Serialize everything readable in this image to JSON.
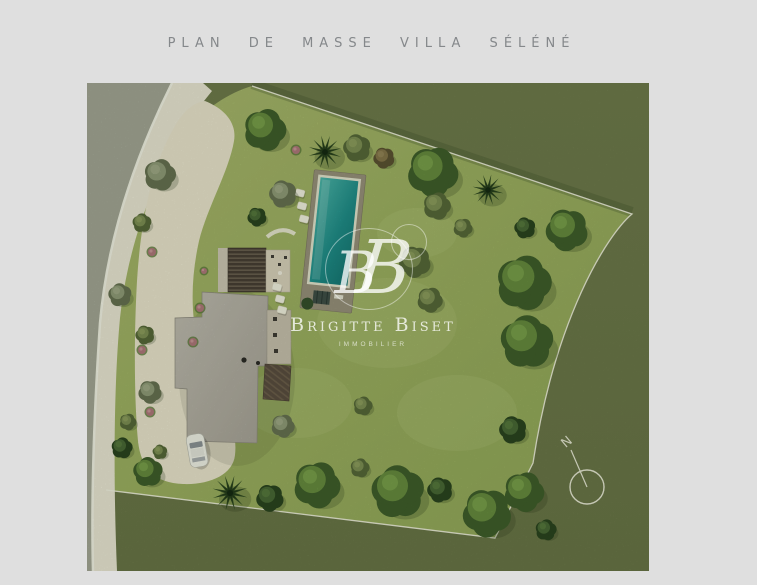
{
  "page": {
    "title": "PLAN DE MASSE VILLA SÉLÉNÉ",
    "title_color": "#85888b",
    "background_color": "#dfdfdf"
  },
  "watermark": {
    "monogram_left": "B",
    "monogram_right": "B",
    "name": "Brigitte Biset",
    "tagline": "IMMOBILIER",
    "color": "#ffffff"
  },
  "compass": {
    "label": "N"
  },
  "palette": {
    "pagebg": "#dfdfdf",
    "outside": "#6e7a4d",
    "lawn": "#9fb163",
    "verge": "#a4a79a",
    "road": "#ece8dc",
    "driveway": "#ece6d5",
    "roof": "#b5b1aa",
    "terrace": "#dbd3c3",
    "poolDeck": "#99927f",
    "boundary": "#f5f4ea"
  },
  "plan": {
    "trees": [
      {
        "x": 178,
        "y": 47,
        "r": 20,
        "tone": "green",
        "shape": "round"
      },
      {
        "x": 238,
        "y": 69,
        "r": 16,
        "tone": "dark",
        "shape": "palm"
      },
      {
        "x": 270,
        "y": 65,
        "r": 13,
        "tone": "olive",
        "shape": "round"
      },
      {
        "x": 297,
        "y": 75,
        "r": 10,
        "tone": "brown",
        "shape": "round"
      },
      {
        "x": 346,
        "y": 89,
        "r": 24,
        "tone": "green",
        "shape": "round"
      },
      {
        "x": 350,
        "y": 123,
        "r": 13,
        "tone": "olive",
        "shape": "round"
      },
      {
        "x": 401,
        "y": 107,
        "r": 15,
        "tone": "dark",
        "shape": "palm"
      },
      {
        "x": 438,
        "y": 145,
        "r": 10,
        "tone": "dark",
        "shape": "round"
      },
      {
        "x": 480,
        "y": 147,
        "r": 20,
        "tone": "green",
        "shape": "round"
      },
      {
        "x": 376,
        "y": 145,
        "r": 9,
        "tone": "olive",
        "shape": "round"
      },
      {
        "x": 437,
        "y": 200,
        "r": 26,
        "tone": "green",
        "shape": "round"
      },
      {
        "x": 440,
        "y": 259,
        "r": 25,
        "tone": "green",
        "shape": "round"
      },
      {
        "x": 426,
        "y": 347,
        "r": 13,
        "tone": "dark",
        "shape": "round"
      },
      {
        "x": 328,
        "y": 179,
        "r": 15,
        "tone": "olive",
        "shape": "round"
      },
      {
        "x": 343,
        "y": 217,
        "r": 12,
        "tone": "olive",
        "shape": "round"
      },
      {
        "x": 73,
        "y": 92,
        "r": 15,
        "tone": "gray",
        "shape": "round"
      },
      {
        "x": 55,
        "y": 140,
        "r": 9,
        "tone": "olive",
        "shape": "round"
      },
      {
        "x": 196,
        "y": 111,
        "r": 13,
        "tone": "gray",
        "shape": "round"
      },
      {
        "x": 170,
        "y": 134,
        "r": 9,
        "tone": "dark",
        "shape": "round"
      },
      {
        "x": 196,
        "y": 343,
        "r": 11,
        "tone": "gray",
        "shape": "round"
      },
      {
        "x": 276,
        "y": 323,
        "r": 9,
        "tone": "olive",
        "shape": "round"
      },
      {
        "x": 61,
        "y": 389,
        "r": 14,
        "tone": "green",
        "shape": "round"
      },
      {
        "x": 143,
        "y": 410,
        "r": 17,
        "tone": "dark",
        "shape": "palm"
      },
      {
        "x": 183,
        "y": 415,
        "r": 13,
        "tone": "dark",
        "shape": "round"
      },
      {
        "x": 230,
        "y": 402,
        "r": 22,
        "tone": "green",
        "shape": "round"
      },
      {
        "x": 273,
        "y": 385,
        "r": 9,
        "tone": "olive",
        "shape": "round"
      },
      {
        "x": 311,
        "y": 409,
        "r": 25,
        "tone": "green",
        "shape": "round"
      },
      {
        "x": 353,
        "y": 407,
        "r": 12,
        "tone": "dark",
        "shape": "round"
      },
      {
        "x": 400,
        "y": 430,
        "r": 23,
        "tone": "green",
        "shape": "round"
      },
      {
        "x": 437,
        "y": 409,
        "r": 19,
        "tone": "green",
        "shape": "round"
      },
      {
        "x": 459,
        "y": 447,
        "r": 10,
        "tone": "dark",
        "shape": "round"
      },
      {
        "x": 33,
        "y": 212,
        "r": 11,
        "tone": "gray",
        "shape": "round"
      },
      {
        "x": 58,
        "y": 252,
        "r": 9,
        "tone": "olive",
        "shape": "round"
      },
      {
        "x": 63,
        "y": 309,
        "r": 11,
        "tone": "gray",
        "shape": "round"
      },
      {
        "x": 41,
        "y": 339,
        "r": 8,
        "tone": "olive",
        "shape": "round"
      },
      {
        "x": 35,
        "y": 365,
        "r": 10,
        "tone": "dark",
        "shape": "round"
      },
      {
        "x": 73,
        "y": 369,
        "r": 7,
        "tone": "olive",
        "shape": "round"
      }
    ],
    "pink_bushes": [
      {
        "x": 65,
        "y": 169,
        "r": 4
      },
      {
        "x": 55,
        "y": 267,
        "r": 4
      },
      {
        "x": 63,
        "y": 329,
        "r": 4
      },
      {
        "x": 113,
        "y": 225,
        "r": 4
      },
      {
        "x": 106,
        "y": 259,
        "r": 4
      },
      {
        "x": 117,
        "y": 188,
        "r": 3
      },
      {
        "x": 209,
        "y": 67,
        "r": 4
      }
    ],
    "stepping_stones": [
      {
        "x": 213,
        "y": 110
      },
      {
        "x": 215,
        "y": 123
      },
      {
        "x": 217,
        "y": 136
      },
      {
        "x": 190,
        "y": 204
      },
      {
        "x": 193,
        "y": 216
      },
      {
        "x": 195,
        "y": 227
      }
    ],
    "light_patches": [
      {
        "x": 300,
        "y": 240,
        "rx": 70,
        "ry": 45
      },
      {
        "x": 210,
        "y": 320,
        "rx": 55,
        "ry": 35
      },
      {
        "x": 370,
        "y": 330,
        "rx": 60,
        "ry": 38
      },
      {
        "x": 330,
        "y": 150,
        "rx": 40,
        "ry": 25
      }
    ]
  }
}
